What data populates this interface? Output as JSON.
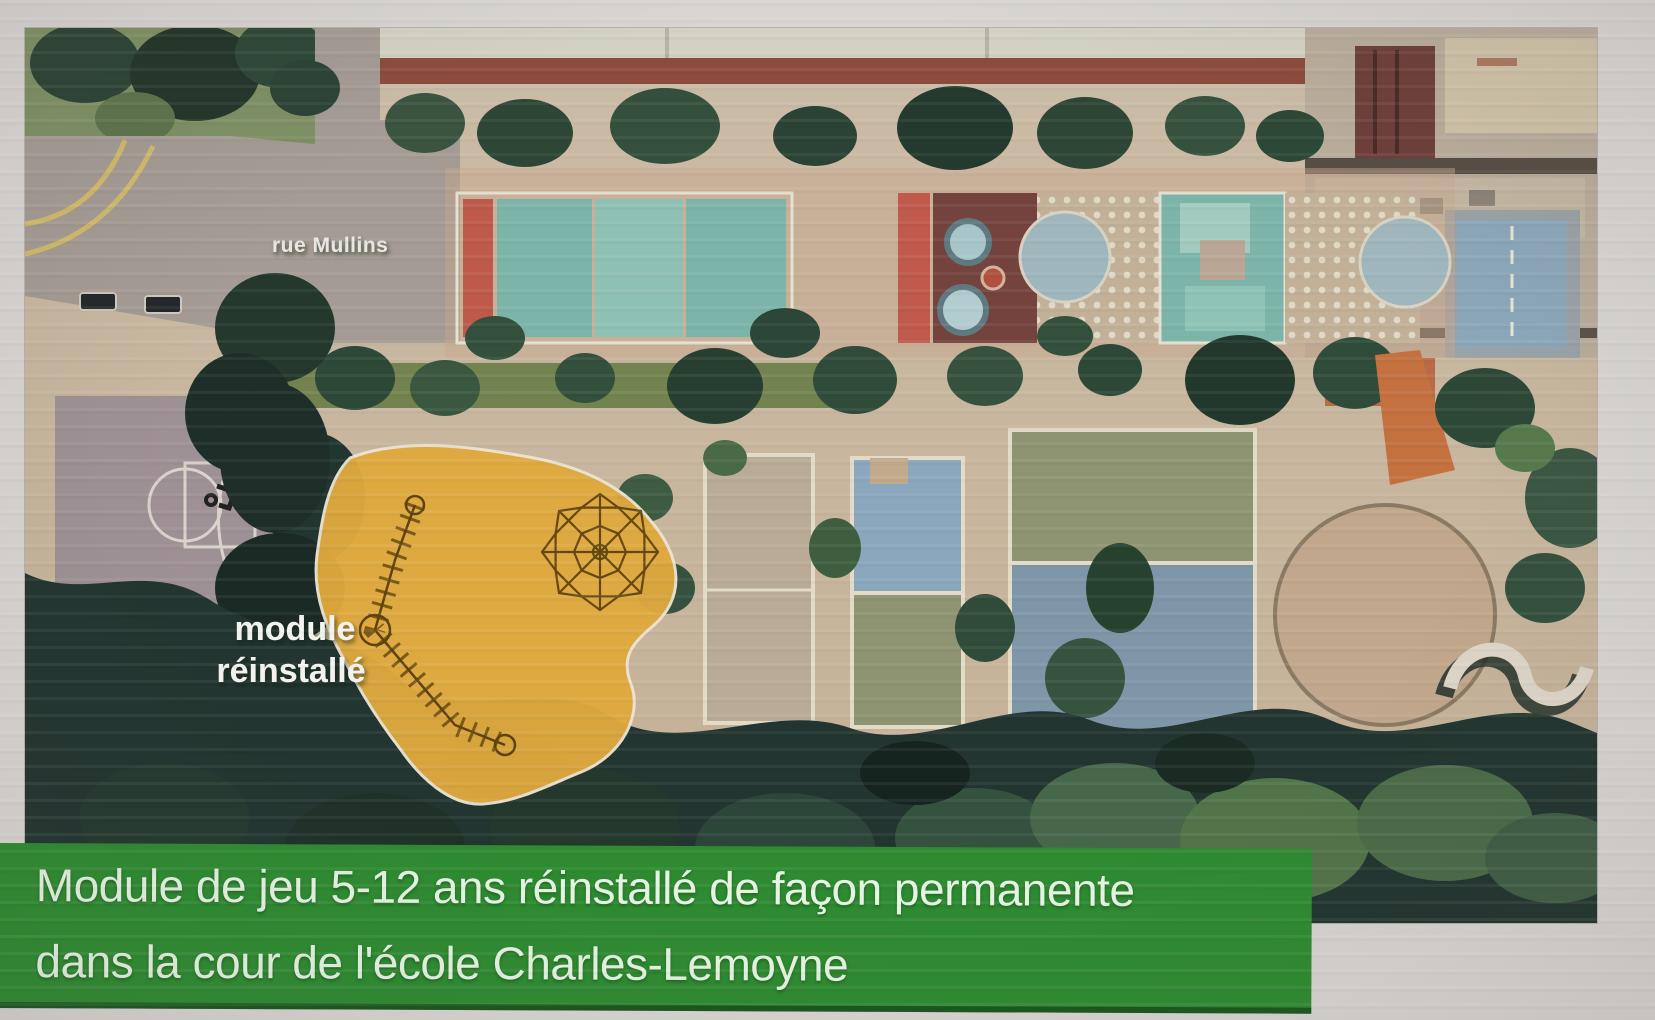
{
  "slide": {
    "background_color": "#d8d5d2"
  },
  "aerial_photo": {
    "street_label": "rue Mullins",
    "module_annotation": {
      "line1": "module",
      "line2": "réinstallé"
    },
    "module_highlight_color": "#dfa93e",
    "drawing_line_color": "#5e430f"
  },
  "caption_banner": {
    "line1": "Module de jeu 5-12 ans réinstallé de façon permanente",
    "line2": "dans la cour de l'école Charles-Lemoyne",
    "background_color": "#2e8b31",
    "text_color": "#e6f4e3"
  }
}
